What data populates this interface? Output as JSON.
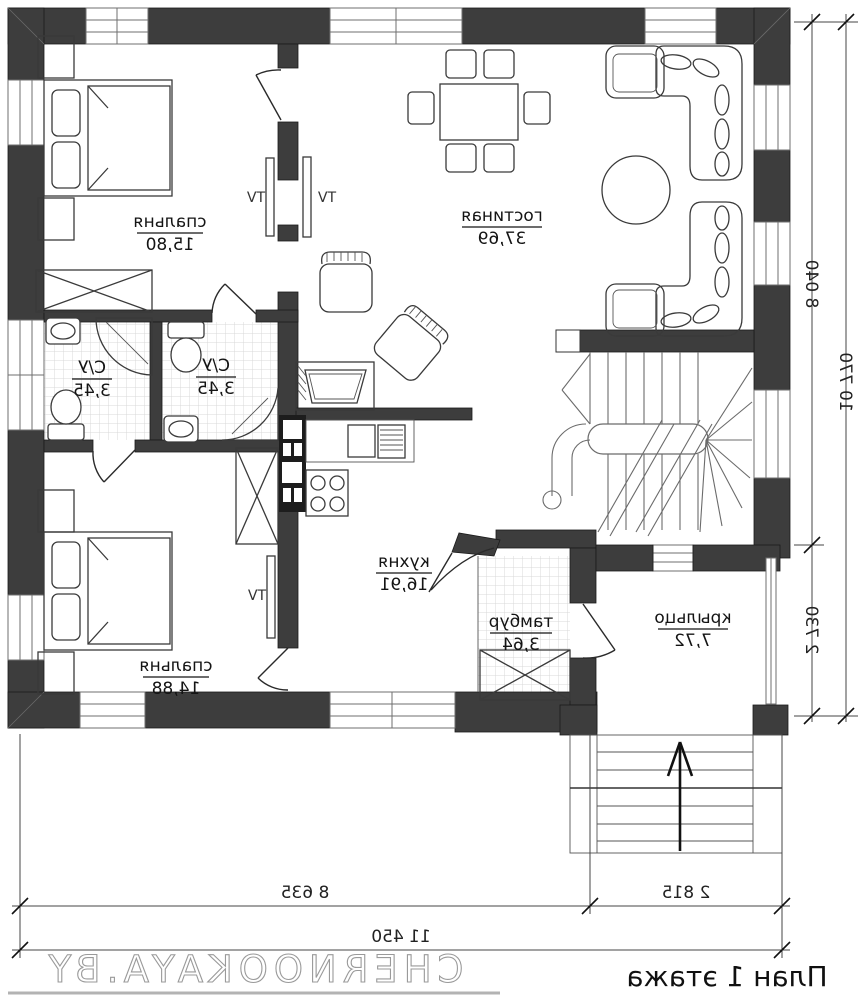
{
  "plan": {
    "title": "План 1 этажа",
    "watermark": "CHERNOOKAYA.BY"
  },
  "rooms": [
    {
      "id": "bedroom-1",
      "name": "спальня",
      "area": "15,80"
    },
    {
      "id": "living-room",
      "name": "гостиная",
      "area": "37,69"
    },
    {
      "id": "bathroom-1",
      "name": "С/У",
      "area": "3,45"
    },
    {
      "id": "bathroom-2",
      "name": "С/У",
      "area": "3,45"
    },
    {
      "id": "kitchen",
      "name": "кухня",
      "area": "16,91"
    },
    {
      "id": "bedroom-2",
      "name": "спальня",
      "area": "14,88"
    },
    {
      "id": "tambour",
      "name": "тамбур",
      "area": "3,64"
    },
    {
      "id": "porch",
      "name": "крыльцо",
      "area": "7,72"
    }
  ],
  "labels": {
    "tv": "TV"
  },
  "dimensions": {
    "right_inner_top": "8 040",
    "right_outer": "10 770",
    "right_inner_bottom": "2 730",
    "bottom_inner_left": "8 635",
    "bottom_inner_right": "2 815",
    "bottom_outer": "11 450"
  },
  "notes": {
    "text_mirrored": "all plan text is horizontally mirrored"
  },
  "colors": {
    "wall": "#3d3d3d",
    "line": "#1b1b1b",
    "tile": "#d9d9d9",
    "watermark": "#9a9a9a"
  }
}
